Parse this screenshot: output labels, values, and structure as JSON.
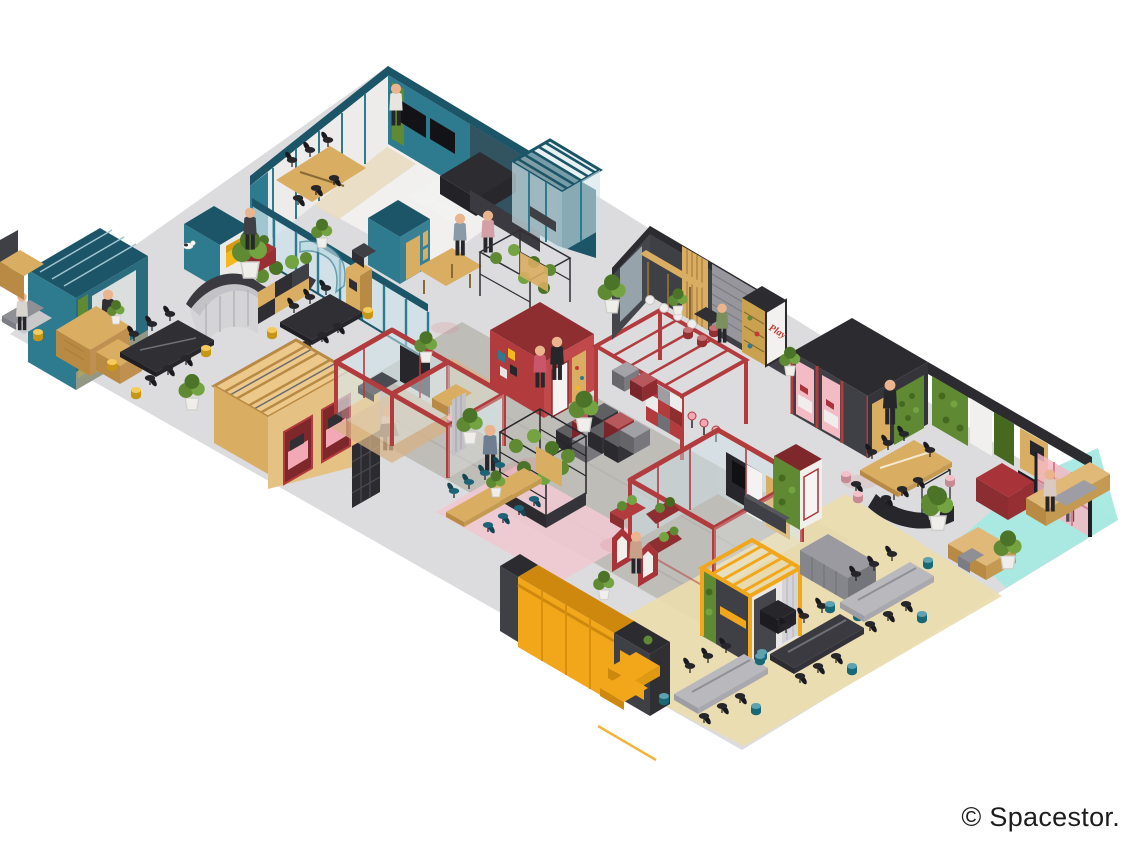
{
  "page": {
    "background": "#ffffff",
    "copyright": "© Spacestor."
  },
  "poster": {
    "text": "Play"
  },
  "palette": {
    "floor": "#dcdcde",
    "walkway": "#bdbab5",
    "sand": "#ecdcae",
    "aqua": "#a7e9e2",
    "rug": "#f0c8d1",
    "teal": "#2e7a8e",
    "tealDark": "#1c5568",
    "tealGlass": "#cfe3ea",
    "red": "#b23b3e",
    "redDark": "#8e2e31",
    "pink": "#f2a9b5",
    "pinkGlass": "#f3b8c3",
    "charcoal": "#3f3f46",
    "charcoalDeep": "#26262b",
    "amber": "#f2a71b",
    "amberDark": "#cf880e",
    "wood": "#d9ad62",
    "woodDark": "#b98a43",
    "woodLight": "#ecc98b",
    "moss": "#5f8a33",
    "mossDark": "#46691f",
    "stoolTeal": "#1f7f93",
    "stoolYellow": "#f4b81d",
    "chairBlue": "#1f6378",
    "ink": "#1c1c1c"
  },
  "scene": {
    "type": "isometric office floor-plan illustration",
    "zones": [
      {
        "id": "teal-suite",
        "label": "Teal meeting suite and kitchen"
      },
      {
        "id": "teal-slat-room",
        "label": "Teal slatted-roof room"
      },
      {
        "id": "teal-booth-row",
        "label": "Teal phone booths"
      },
      {
        "id": "reception-pod",
        "label": "Teal reception pod"
      },
      {
        "id": "reception-desk",
        "label": "Curved reception counter with planting"
      },
      {
        "id": "conference-left",
        "label": "Black conference tables with yellow stools"
      },
      {
        "id": "wood-pergola-room",
        "label": "Timber pergola booths"
      },
      {
        "id": "red-meeting-rooms",
        "label": "Red framed glass meeting rooms"
      },
      {
        "id": "red-phone-booths",
        "label": "Red phone booth row"
      },
      {
        "id": "red-pergola-lounge",
        "label": "Red pergola lounge with chequer wall"
      },
      {
        "id": "modular-cube-seating",
        "label": "Modular cube seating"
      },
      {
        "id": "plant-shelving",
        "label": "Wire plant shelving"
      },
      {
        "id": "rug-table",
        "label": "Long table with blue chairs on pink rug"
      },
      {
        "id": "cafe-room",
        "label": "Charcoal café with bar and Play poster"
      },
      {
        "id": "focus-booth-row",
        "label": "Charcoal booths with pink seating"
      },
      {
        "id": "executive-wing",
        "label": "Black wing with moss walls and red desk"
      },
      {
        "id": "pink-glass-room",
        "label": "Pink glass room"
      },
      {
        "id": "right-conference",
        "label": "Timber conference table with pink stools"
      },
      {
        "id": "aqua-lounge",
        "label": "Aqua lounge with timber planters"
      },
      {
        "id": "red-project-room",
        "label": "Red project room"
      },
      {
        "id": "planted-pods",
        "label": "Gabled planted pods"
      },
      {
        "id": "yellow-lockers",
        "label": "Yellow locker wall and steps"
      },
      {
        "id": "yellow-pod",
        "label": "Yellow pergola pod"
      },
      {
        "id": "open-workspace",
        "label": "Open workspace desks with teal stools"
      }
    ]
  }
}
